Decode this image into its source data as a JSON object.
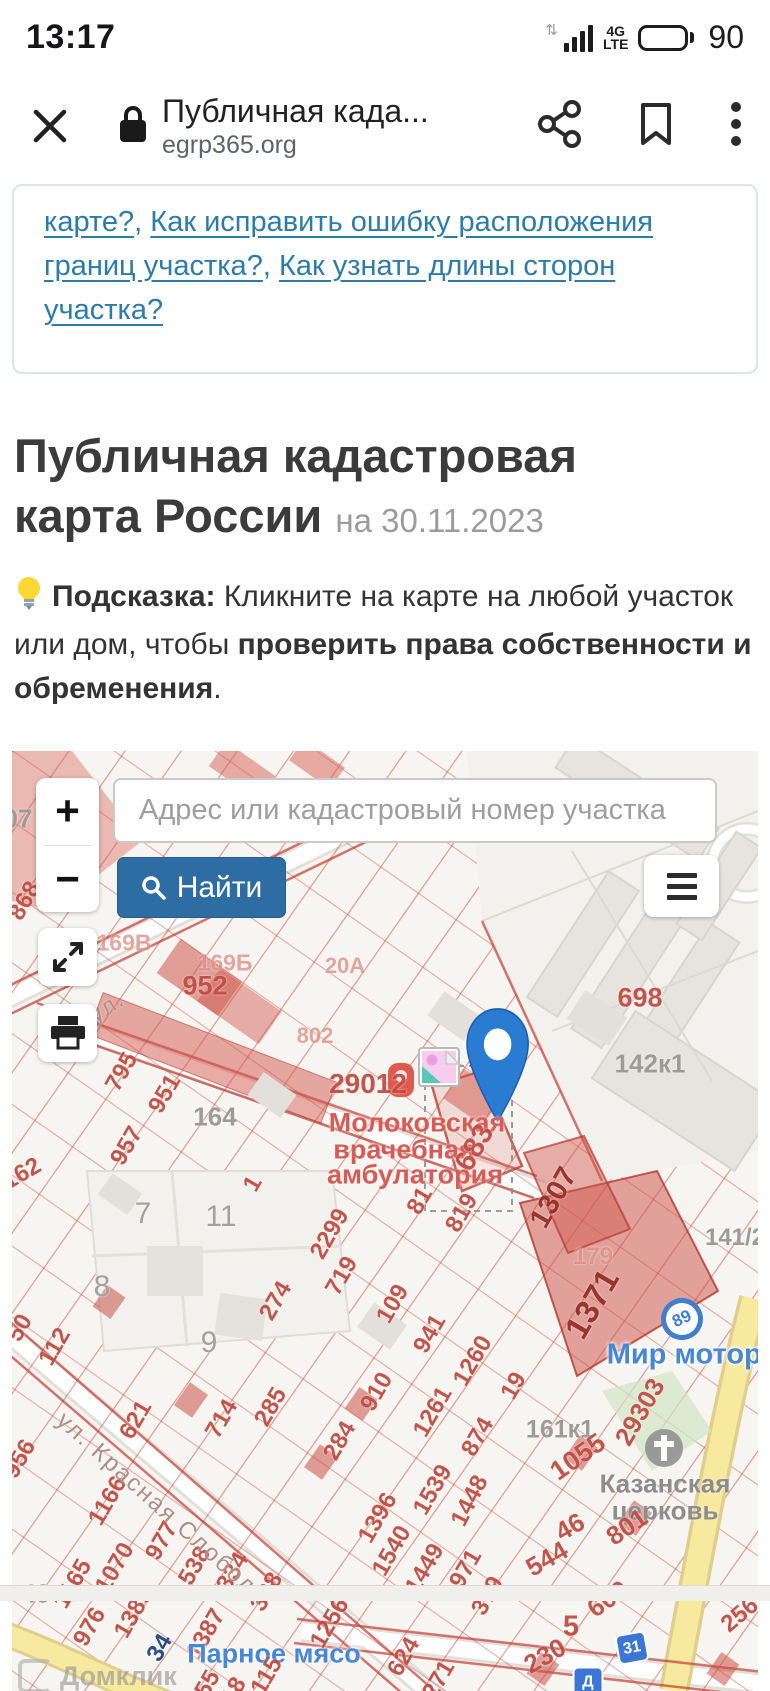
{
  "status_bar": {
    "time": "13:17",
    "battery_level": "90",
    "network_top": "4G",
    "network_bottom": "LTE"
  },
  "browser_bar": {
    "title": "Публичная када...",
    "url": "egrp365.org"
  },
  "notice": {
    "links": [
      "карте?",
      "Как исправить ошибку расположения границ участка?",
      "Как узнать длины сторон участка?"
    ],
    "separator": ", "
  },
  "heading": {
    "title": "Публичная кадастровая карта России",
    "date_suffix": "на 30.11.2023"
  },
  "tip": {
    "parts": [
      {
        "text": "Подсказка:",
        "bold": true
      },
      {
        "text": " Кликните на карте на любой участок или дом, чтобы ",
        "bold": false
      },
      {
        "text": "проверить права собственности и обременения",
        "bold": true
      },
      {
        "text": ".",
        "bold": false
      }
    ]
  },
  "map": {
    "search_placeholder": "Адрес или кадастровый номер участка",
    "find_button": "Найти",
    "zoom_in": "+",
    "zoom_out": "−",
    "watermark": "Домклик",
    "labels": [
      {
        "t": "07",
        "x": 6,
        "y": 68,
        "c": "gry",
        "s": 26
      },
      {
        "t": "868",
        "x": 13,
        "y": 150,
        "r": -60,
        "c": "rr"
      },
      {
        "t": "169В",
        "x": 112,
        "y": 192,
        "c": "fad",
        "s": 23
      },
      {
        "t": "169Б",
        "x": 213,
        "y": 212,
        "c": "fad",
        "s": 23
      },
      {
        "t": "952",
        "x": 193,
        "y": 235,
        "c": "rr",
        "s": 27
      },
      {
        "t": "20А",
        "x": 333,
        "y": 215,
        "c": "fad",
        "s": 22
      },
      {
        "t": "802",
        "x": 303,
        "y": 285,
        "c": "fad",
        "s": 22
      },
      {
        "t": "29012",
        "x": 356,
        "y": 333,
        "c": "rr",
        "s": 28
      },
      {
        "t": "Молоковская",
        "x": 405,
        "y": 372,
        "c": "medr",
        "s": 27
      },
      {
        "t": "врачебная",
        "x": 392,
        "y": 399,
        "c": "medr",
        "s": 27
      },
      {
        "t": "амбулатория",
        "x": 403,
        "y": 424,
        "c": "medr",
        "s": 27
      },
      {
        "t": "683",
        "x": 463,
        "y": 397,
        "r": -60,
        "c": "rr",
        "s": 29
      },
      {
        "t": "81",
        "x": 408,
        "y": 450,
        "r": -60,
        "c": "rr"
      },
      {
        "t": "819",
        "x": 450,
        "y": 462,
        "r": -60,
        "c": "rr"
      },
      {
        "t": "1307",
        "x": 542,
        "y": 447,
        "r": -60,
        "c": "dkr",
        "s": 29
      },
      {
        "t": "698",
        "x": 628,
        "y": 247,
        "c": "rr",
        "s": 27
      },
      {
        "t": "142к1",
        "x": 638,
        "y": 313,
        "c": "gry",
        "s": 26
      },
      {
        "t": "141/2",
        "x": 723,
        "y": 487,
        "c": "gry",
        "s": 24
      },
      {
        "t": "179",
        "x": 581,
        "y": 506,
        "c": "fad",
        "s": 24
      },
      {
        "t": "1371",
        "x": 580,
        "y": 553,
        "r": -60,
        "c": "dkr",
        "s": 33
      },
      {
        "t": "Мир моторов",
        "x": 690,
        "y": 604,
        "c": "blu",
        "s": 29
      },
      {
        "t": "29303",
        "x": 628,
        "y": 661,
        "r": -60,
        "c": "rr",
        "s": 26
      },
      {
        "t": "161к1",
        "x": 548,
        "y": 679,
        "c": "gry",
        "s": 25
      },
      {
        "t": "1055",
        "x": 566,
        "y": 706,
        "r": -35,
        "c": "rr",
        "s": 27
      },
      {
        "t": "Казанская",
        "x": 653,
        "y": 733,
        "c": "chz"
      },
      {
        "t": "церковь",
        "x": 653,
        "y": 760,
        "c": "chz"
      },
      {
        "t": "801",
        "x": 615,
        "y": 776,
        "r": -35,
        "c": "rr",
        "s": 26
      },
      {
        "t": "46",
        "x": 558,
        "y": 776,
        "r": -30,
        "c": "rr",
        "s": 26
      },
      {
        "t": "544",
        "x": 535,
        "y": 808,
        "r": -30,
        "c": "rr",
        "s": 26
      },
      {
        "t": "600",
        "x": 596,
        "y": 848,
        "r": -35,
        "c": "rr",
        "s": 26
      },
      {
        "t": "5",
        "x": 559,
        "y": 876,
        "c": "rr",
        "s": 29
      },
      {
        "t": "230",
        "x": 533,
        "y": 905,
        "r": -30,
        "c": "rr",
        "s": 26
      },
      {
        "t": "256",
        "x": 728,
        "y": 864,
        "r": -40,
        "c": "rr"
      },
      {
        "t": "379",
        "x": 476,
        "y": 845,
        "r": -60,
        "c": "rr"
      },
      {
        "t": "971",
        "x": 454,
        "y": 818,
        "r": -60,
        "c": "rr"
      },
      {
        "t": "1448",
        "x": 458,
        "y": 750,
        "r": -63,
        "c": "rr"
      },
      {
        "t": "1539",
        "x": 421,
        "y": 739,
        "r": -60,
        "c": "rr"
      },
      {
        "t": "1449",
        "x": 413,
        "y": 818,
        "r": -60,
        "c": "rr"
      },
      {
        "t": "1540",
        "x": 380,
        "y": 800,
        "r": -60,
        "c": "rr"
      },
      {
        "t": "624",
        "x": 392,
        "y": 906,
        "r": -60,
        "c": "rr"
      },
      {
        "t": "271",
        "x": 427,
        "y": 929,
        "r": -60,
        "c": "rr"
      },
      {
        "t": "7",
        "x": 131,
        "y": 463,
        "c": "gry2"
      },
      {
        "t": "11",
        "x": 209,
        "y": 466,
        "c": "gry2"
      },
      {
        "t": "8",
        "x": 90,
        "y": 536,
        "c": "gry2"
      },
      {
        "t": "9",
        "x": 197,
        "y": 592,
        "c": "gry2"
      },
      {
        "t": "50",
        "x": 8,
        "y": 577,
        "r": -60,
        "c": "rr"
      },
      {
        "t": "112",
        "x": 43,
        "y": 596,
        "r": -60,
        "c": "rr"
      },
      {
        "t": "274",
        "x": 264,
        "y": 550,
        "r": -60,
        "c": "rr"
      },
      {
        "t": "2299",
        "x": 318,
        "y": 483,
        "r": -60,
        "c": "rr"
      },
      {
        "t": "719",
        "x": 330,
        "y": 525,
        "r": -60,
        "c": "rr"
      },
      {
        "t": "109",
        "x": 381,
        "y": 553,
        "r": -60,
        "c": "rr"
      },
      {
        "t": "941",
        "x": 418,
        "y": 583,
        "r": -60,
        "c": "rr"
      },
      {
        "t": "1260",
        "x": 461,
        "y": 610,
        "r": -60,
        "c": "rr"
      },
      {
        "t": "19",
        "x": 502,
        "y": 635,
        "r": -60,
        "c": "rr"
      },
      {
        "t": "910",
        "x": 365,
        "y": 641,
        "r": -60,
        "c": "rr"
      },
      {
        "t": "1261",
        "x": 421,
        "y": 661,
        "r": -60,
        "c": "rr"
      },
      {
        "t": "874",
        "x": 466,
        "y": 686,
        "r": -60,
        "c": "rr"
      },
      {
        "t": "621",
        "x": 124,
        "y": 669,
        "r": -60,
        "c": "rr"
      },
      {
        "t": "714",
        "x": 210,
        "y": 668,
        "r": -60,
        "c": "rr"
      },
      {
        "t": "285",
        "x": 259,
        "y": 656,
        "r": -60,
        "c": "rr"
      },
      {
        "t": "284",
        "x": 328,
        "y": 690,
        "r": -60,
        "c": "rr"
      },
      {
        "t": "1396",
        "x": 366,
        "y": 767,
        "r": -60,
        "c": "rr"
      },
      {
        "t": "956",
        "x": 8,
        "y": 708,
        "r": -60,
        "c": "rr"
      },
      {
        "t": "1166",
        "x": 96,
        "y": 750,
        "r": -60,
        "c": "rr"
      },
      {
        "t": "1070",
        "x": 103,
        "y": 817,
        "r": -60,
        "c": "rr"
      },
      {
        "t": "1165",
        "x": 61,
        "y": 833,
        "r": -60,
        "c": "rr"
      },
      {
        "t": "49",
        "x": 24,
        "y": 843,
        "c": "gry",
        "s": 26
      },
      {
        "t": "976",
        "x": 78,
        "y": 876,
        "r": -60,
        "c": "rr"
      },
      {
        "t": "1389",
        "x": 122,
        "y": 862,
        "r": -60,
        "c": "rr"
      },
      {
        "t": "977",
        "x": 150,
        "y": 790,
        "r": -60,
        "c": "rr"
      },
      {
        "t": "538",
        "x": 183,
        "y": 815,
        "r": -60,
        "c": "rr"
      },
      {
        "t": "334",
        "x": 221,
        "y": 821,
        "r": -60,
        "c": "rr"
      },
      {
        "t": "328",
        "x": 255,
        "y": 841,
        "r": -60,
        "c": "rr"
      },
      {
        "t": "1387",
        "x": 194,
        "y": 883,
        "r": -60,
        "c": "rr"
      },
      {
        "t": "34",
        "x": 148,
        "y": 897,
        "r": -60,
        "c": "dkb"
      },
      {
        "t": "Парное мясо",
        "x": 262,
        "y": 903,
        "c": "blu",
        "s": 27
      },
      {
        "t": "1256",
        "x": 318,
        "y": 872,
        "r": -60,
        "c": "rr"
      },
      {
        "t": "115",
        "x": 255,
        "y": 925,
        "r": -60,
        "c": "rr"
      },
      {
        "t": "55",
        "x": 196,
        "y": 933,
        "r": -60,
        "c": "rr"
      },
      {
        "t": "18",
        "x": 222,
        "y": 940,
        "r": -60,
        "c": "rr"
      },
      {
        "t": "162",
        "x": 10,
        "y": 423,
        "r": -30,
        "c": "rr"
      },
      {
        "t": "1",
        "x": 241,
        "y": 433,
        "r": -60,
        "c": "rr"
      },
      {
        "t": "164",
        "x": 203,
        "y": 366,
        "c": "gry",
        "s": 26
      },
      {
        "t": "795",
        "x": 110,
        "y": 321,
        "r": -60,
        "c": "rr"
      },
      {
        "t": "951",
        "x": 153,
        "y": 343,
        "r": -60,
        "c": "rr"
      },
      {
        "t": "957",
        "x": 115,
        "y": 395,
        "r": -60,
        "c": "rr"
      },
      {
        "t": "ная ул.",
        "x": 73,
        "y": 270,
        "r": -33,
        "c": "street"
      },
      {
        "t": "ул. Красная Слобода",
        "x": 150,
        "y": 758,
        "r": 42,
        "c": "street",
        "s": 24
      },
      {
        "t": "89",
        "x": 670,
        "y": 568,
        "r": -25,
        "c": "bstop"
      },
      {
        "t": "31",
        "x": 620,
        "y": 897,
        "r": -10,
        "c": "bsign"
      },
      {
        "t": "Д",
        "x": 576,
        "y": 931,
        "c": "bsign"
      }
    ]
  },
  "colors": {
    "accent_blue": "#2e6da4",
    "link_blue": "#2c7cab",
    "parcel_red": "#c24238",
    "pin_blue": "#2a7bd2",
    "road_yellow": "#f7ea9f"
  }
}
